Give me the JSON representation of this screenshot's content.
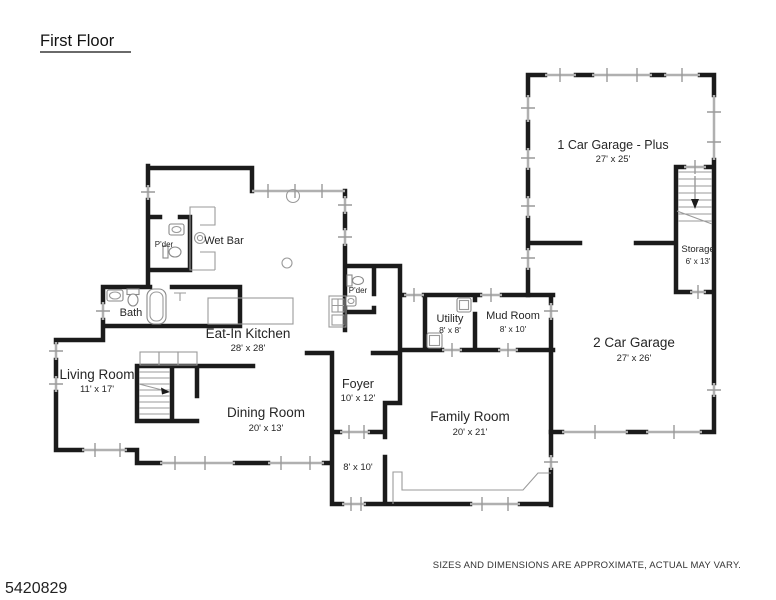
{
  "title": "First Floor",
  "footer": {
    "listing_id": "5420829",
    "disclaimer": "SIZES AND DIMENSIONS ARE APPROXIMATE, ACTUAL MAY VARY."
  },
  "rooms": {
    "kitchen": {
      "name": "Eat-In Kitchen",
      "dims": "28' x 28'"
    },
    "living": {
      "name": "Living Room",
      "dims": "11' x 17'"
    },
    "dining": {
      "name": "Dining Room",
      "dims": "20' x 13'"
    },
    "foyer": {
      "name": "Foyer",
      "dims": "10' x 12'"
    },
    "family": {
      "name": "Family Room",
      "dims": "20' x 21'"
    },
    "bonus": {
      "name": "",
      "dims": "8' x 10'"
    },
    "utility": {
      "name": "Utility",
      "dims": "8' x 8'"
    },
    "mud": {
      "name": "Mud Room",
      "dims": "8' x 10'"
    },
    "bath": {
      "name": "Bath"
    },
    "powder_upper": {
      "name": "P'der"
    },
    "powder_center": {
      "name": "P'der"
    },
    "wet_bar": {
      "name": "Wet Bar"
    },
    "garage_one": {
      "name": "1 Car Garage - Plus",
      "dims": "27' x 25'"
    },
    "garage_two": {
      "name": "2 Car Garage",
      "dims": "27' x 26'"
    },
    "storage": {
      "name": "Storage",
      "dims": "6' x 13'"
    }
  },
  "colors": {
    "wall": "#1b1b1b",
    "window": "#b0b0b0",
    "fixture": "#9a9a9a",
    "text": "#262626",
    "background": "#ffffff"
  }
}
